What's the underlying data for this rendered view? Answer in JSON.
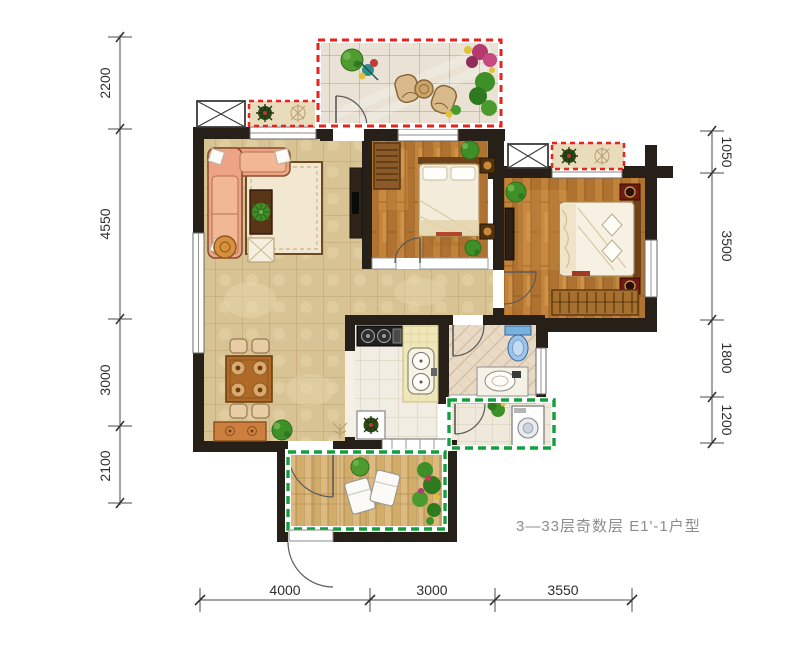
{
  "caption": {
    "text": "3—33层奇数层 E1'-1户型"
  },
  "dimensions": {
    "left": [
      "2200",
      "4550",
      "3000",
      "2100"
    ],
    "right": [
      "1050",
      "3500",
      "1800",
      "1200"
    ],
    "bottom": [
      "4000",
      "3000",
      "3550"
    ]
  },
  "colors": {
    "wall": "#262019",
    "red_dash": "#e8231c",
    "green_dash": "#149f3d",
    "dim_line": "#4a4a4a",
    "dim_text": "#2e2e2e",
    "caption_text": "#8d8d8d",
    "tile_floor": "#d8c395",
    "wood_floor": "#c2823a",
    "terrace_floor": "#eae3d5",
    "kitchen_floor": "#f2ede2",
    "bath_floor": "#e8dac4",
    "balcony_floor": "#ddbb80",
    "sofa": "#eda486",
    "bed_linen": "#f4eedd",
    "plant_green": "#3f8f28",
    "counter_yellow": "#efe7b8",
    "toilet_blue": "#9cc4e8"
  },
  "icons": {
    "shaft_cross": "box-with-x",
    "door_swing": "quarter-arc",
    "window": "double-line-band",
    "plant": "foliage-cluster",
    "washer": "drum-circle"
  }
}
